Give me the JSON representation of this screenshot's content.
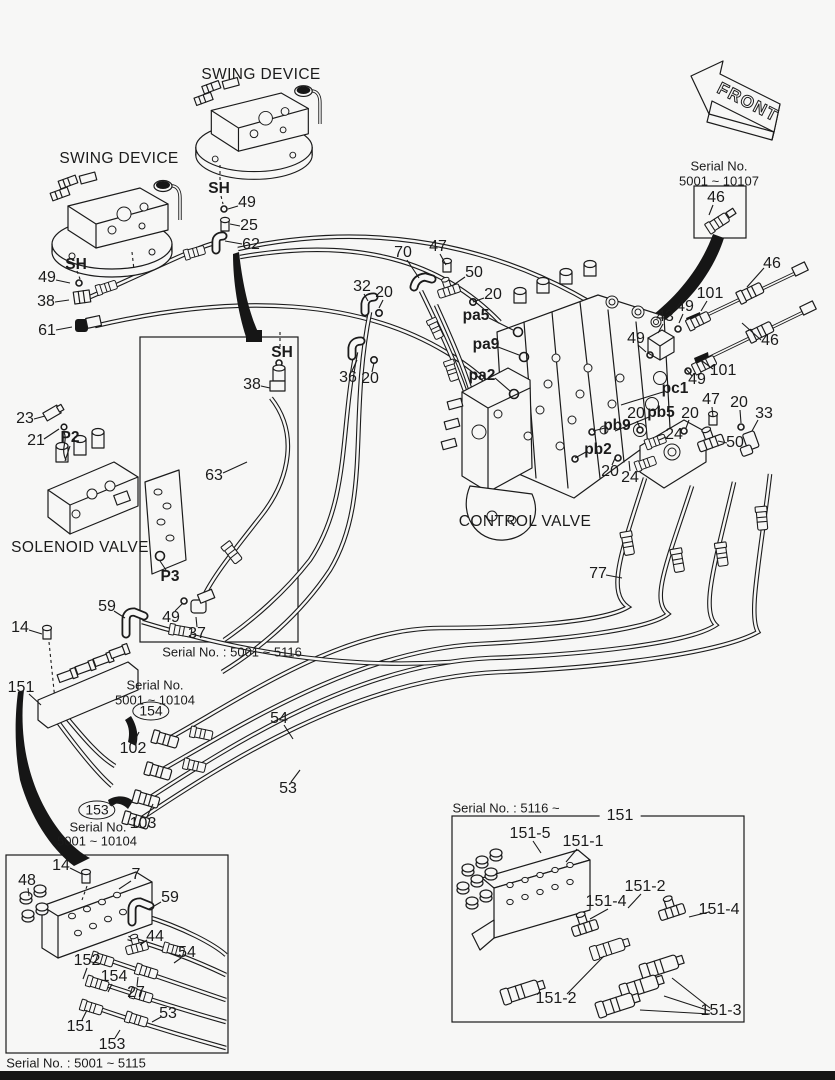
{
  "front_arrow": {
    "label": "FRONT"
  },
  "labels": [
    {
      "t": "SWING DEVICE",
      "x": 261,
      "y": 75,
      "c": "title"
    },
    {
      "t": "SWING DEVICE",
      "x": 119,
      "y": 159,
      "c": "title"
    },
    {
      "t": "SOLENOID VALVE",
      "x": 80,
      "y": 548,
      "c": "title"
    },
    {
      "t": "CONTROL VALVE",
      "x": 525,
      "y": 522,
      "c": "title"
    },
    {
      "t": "Serial No.",
      "x": 719,
      "y": 166,
      "c": "serial"
    },
    {
      "t": "5001 ~ 10107",
      "x": 719,
      "y": 181,
      "c": "serial"
    },
    {
      "t": "46",
      "x": 716,
      "y": 198,
      "c": "num",
      "l": [
        [
          713,
          205,
          709,
          215
        ]
      ]
    },
    {
      "t": "SH",
      "x": 219,
      "y": 189,
      "c": "port"
    },
    {
      "t": "49",
      "x": 247,
      "y": 203,
      "c": "num",
      "l": [
        [
          238,
          206,
          228,
          209
        ]
      ]
    },
    {
      "t": "25",
      "x": 249,
      "y": 226,
      "c": "num",
      "l": [
        [
          240,
          226,
          230,
          224
        ]
      ]
    },
    {
      "t": "62",
      "x": 251,
      "y": 245,
      "c": "num",
      "l": [
        [
          242,
          244,
          225,
          241
        ]
      ]
    },
    {
      "t": "SH",
      "x": 76,
      "y": 265,
      "c": "port"
    },
    {
      "t": "49",
      "x": 47,
      "y": 278,
      "c": "num",
      "l": [
        [
          56,
          280,
          70,
          283
        ]
      ]
    },
    {
      "t": "38",
      "x": 46,
      "y": 302,
      "c": "num",
      "l": [
        [
          55,
          302,
          69,
          300
        ]
      ]
    },
    {
      "t": "61",
      "x": 47,
      "y": 331,
      "c": "num",
      "l": [
        [
          56,
          330,
          72,
          327
        ]
      ]
    },
    {
      "t": "70",
      "x": 403,
      "y": 253,
      "c": "num",
      "l": [
        [
          407,
          260,
          419,
          278
        ]
      ]
    },
    {
      "t": "47",
      "x": 438,
      "y": 247,
      "c": "num",
      "l": [
        [
          440,
          254,
          446,
          265
        ]
      ]
    },
    {
      "t": "50",
      "x": 474,
      "y": 273,
      "c": "num",
      "l": [
        [
          465,
          277,
          452,
          286
        ]
      ]
    },
    {
      "t": "32",
      "x": 362,
      "y": 287,
      "c": "num",
      "l": [
        [
          364,
          294,
          368,
          301
        ]
      ]
    },
    {
      "t": "20",
      "x": 384,
      "y": 293,
      "c": "num",
      "l": [
        [
          383,
          300,
          379,
          308
        ]
      ]
    },
    {
      "t": "20",
      "x": 493,
      "y": 295,
      "c": "num",
      "l": [
        [
          484,
          298,
          473,
          302
        ]
      ]
    },
    {
      "t": "pa5",
      "x": 476,
      "y": 316,
      "c": "port",
      "l": [
        [
          489,
          318,
          513,
          330
        ]
      ]
    },
    {
      "t": "pa9",
      "x": 486,
      "y": 345,
      "c": "port",
      "l": [
        [
          498,
          347,
          519,
          355
        ]
      ]
    },
    {
      "t": "pa2",
      "x": 482,
      "y": 376,
      "c": "port",
      "l": [
        [
          495,
          378,
          510,
          391
        ]
      ]
    },
    {
      "t": "36",
      "x": 348,
      "y": 378,
      "c": "num",
      "l": [
        [
          352,
          371,
          357,
          360
        ]
      ]
    },
    {
      "t": "20",
      "x": 370,
      "y": 379,
      "c": "num",
      "l": [
        [
          372,
          372,
          374,
          363
        ]
      ]
    },
    {
      "t": "46",
      "x": 772,
      "y": 264,
      "c": "num",
      "l": [
        [
          764,
          268,
          747,
          287
        ]
      ]
    },
    {
      "t": "101",
      "x": 710,
      "y": 294,
      "c": "num",
      "l": [
        [
          707,
          301,
          701,
          311
        ]
      ]
    },
    {
      "t": "49",
      "x": 685,
      "y": 307,
      "c": "num",
      "l": [
        [
          683,
          314,
          679,
          323
        ]
      ]
    },
    {
      "t": "43",
      "x": 665,
      "y": 317,
      "c": "num",
      "l": [
        [
          663,
          324,
          658,
          333
        ]
      ]
    },
    {
      "t": "49",
      "x": 636,
      "y": 339,
      "c": "num",
      "l": [
        [
          638,
          345,
          646,
          352
        ]
      ]
    },
    {
      "t": "46",
      "x": 770,
      "y": 341,
      "c": "num",
      "l": [
        [
          761,
          340,
          742,
          323
        ]
      ]
    },
    {
      "t": "101",
      "x": 723,
      "y": 371,
      "c": "num",
      "l": [
        [
          713,
          369,
          702,
          361
        ]
      ]
    },
    {
      "t": "49",
      "x": 697,
      "y": 380,
      "c": "num",
      "l": [
        [
          692,
          376,
          686,
          369
        ]
      ]
    },
    {
      "t": "pc1",
      "x": 675,
      "y": 389,
      "c": "port",
      "l": [
        [
          663,
          392,
          621,
          405
        ]
      ]
    },
    {
      "t": "20",
      "x": 636,
      "y": 414,
      "c": "num",
      "l": [
        [
          637,
          421,
          640,
          428
        ]
      ]
    },
    {
      "t": "pb5",
      "x": 661,
      "y": 413,
      "c": "port",
      "l": [
        [
          649,
          417,
          615,
          431
        ]
      ]
    },
    {
      "t": "20",
      "x": 690,
      "y": 414,
      "c": "num",
      "l": [
        [
          689,
          420,
          686,
          428
        ]
      ]
    },
    {
      "t": "47",
      "x": 711,
      "y": 400,
      "c": "num",
      "l": [
        [
          712,
          407,
          713,
          417
        ]
      ]
    },
    {
      "t": "20",
      "x": 739,
      "y": 403,
      "c": "num",
      "l": [
        [
          740,
          410,
          741,
          423
        ]
      ]
    },
    {
      "t": "33",
      "x": 764,
      "y": 414,
      "c": "num",
      "l": [
        [
          758,
          420,
          752,
          431
        ]
      ]
    },
    {
      "t": "pb9",
      "x": 617,
      "y": 426,
      "c": "port",
      "l": [
        [
          605,
          428,
          593,
          431
        ]
      ]
    },
    {
      "t": "24",
      "x": 674,
      "y": 435,
      "c": "num",
      "l": [
        [
          666,
          437,
          659,
          440
        ]
      ]
    },
    {
      "t": "pb2",
      "x": 598,
      "y": 450,
      "c": "port",
      "l": [
        [
          586,
          452,
          575,
          458
        ]
      ]
    },
    {
      "t": "50",
      "x": 735,
      "y": 443,
      "c": "num",
      "l": [
        [
          727,
          443,
          718,
          441
        ]
      ]
    },
    {
      "t": "20",
      "x": 610,
      "y": 472,
      "c": "num",
      "l": [
        [
          612,
          465,
          616,
          456
        ]
      ]
    },
    {
      "t": "24",
      "x": 630,
      "y": 478,
      "c": "num",
      "l": [
        [
          630,
          471,
          629,
          461
        ]
      ]
    },
    {
      "t": "77",
      "x": 598,
      "y": 574,
      "c": "num",
      "l": [
        [
          606,
          575,
          622,
          578
        ]
      ]
    },
    {
      "t": "23",
      "x": 25,
      "y": 419,
      "c": "num",
      "l": [
        [
          34,
          419,
          45,
          416
        ]
      ]
    },
    {
      "t": "21",
      "x": 36,
      "y": 441,
      "c": "num",
      "l": [
        [
          44,
          439,
          59,
          429
        ]
      ]
    },
    {
      "t": "P2",
      "x": 70,
      "y": 438,
      "c": "port",
      "l": [
        [
          70,
          446,
          65,
          461
        ]
      ]
    },
    {
      "t": "SH",
      "x": 282,
      "y": 353,
      "c": "port"
    },
    {
      "t": "38",
      "x": 252,
      "y": 385,
      "c": "num",
      "l": [
        [
          261,
          386,
          270,
          388
        ]
      ]
    },
    {
      "t": "63",
      "x": 214,
      "y": 476,
      "c": "num",
      "l": [
        [
          223,
          473,
          247,
          462
        ]
      ]
    },
    {
      "t": "P3",
      "x": 170,
      "y": 577,
      "c": "port",
      "l": [
        [
          166,
          570,
          160,
          561
        ]
      ]
    },
    {
      "t": "49",
      "x": 171,
      "y": 618,
      "c": "num",
      "l": [
        [
          175,
          611,
          182,
          604
        ]
      ]
    },
    {
      "t": "37",
      "x": 197,
      "y": 634,
      "c": "num",
      "l": [
        [
          197,
          627,
          196,
          617
        ]
      ]
    },
    {
      "t": "59",
      "x": 107,
      "y": 607,
      "c": "num",
      "l": [
        [
          114,
          611,
          125,
          618
        ]
      ]
    },
    {
      "t": "14",
      "x": 20,
      "y": 628,
      "c": "num",
      "l": [
        [
          29,
          630,
          42,
          634
        ]
      ]
    },
    {
      "t": "151",
      "x": 21,
      "y": 688,
      "c": "num",
      "l": [
        [
          29,
          694,
          41,
          705
        ]
      ]
    },
    {
      "t": "Serial No.",
      "x": 155,
      "y": 685,
      "c": "serial"
    },
    {
      "t": "5001 ~ 10104",
      "x": 155,
      "y": 700,
      "c": "serial"
    },
    {
      "t": "154",
      "x": 151,
      "y": 711,
      "c": "circ"
    },
    {
      "t": "102",
      "x": 133,
      "y": 749,
      "c": "num",
      "l": [
        [
          134,
          742,
          139,
          732
        ]
      ]
    },
    {
      "t": "54",
      "x": 279,
      "y": 719,
      "c": "num",
      "l": [
        [
          284,
          725,
          293,
          739
        ]
      ]
    },
    {
      "t": "53",
      "x": 288,
      "y": 789,
      "c": "num",
      "l": [
        [
          291,
          782,
          300,
          770
        ]
      ]
    },
    {
      "t": "153",
      "x": 97,
      "y": 810,
      "c": "circ",
      "l": [
        [
          111,
          806,
          121,
          800
        ]
      ]
    },
    {
      "t": "Serial No.",
      "x": 98,
      "y": 827,
      "c": "serial"
    },
    {
      "t": "5001 ~ 10104",
      "x": 97,
      "y": 841,
      "c": "serial"
    },
    {
      "t": "103",
      "x": 143,
      "y": 824,
      "c": "num",
      "l": [
        [
          147,
          817,
          153,
          804
        ]
      ]
    },
    {
      "t": "Serial No. : 5001 ~ 5116",
      "x": 232,
      "y": 652,
      "c": "serial"
    },
    {
      "t": "14",
      "x": 61,
      "y": 866,
      "c": "num",
      "l": [
        [
          70,
          868,
          82,
          874
        ]
      ]
    },
    {
      "t": "7",
      "x": 136,
      "y": 875,
      "c": "num",
      "l": [
        [
          131,
          881,
          119,
          889
        ]
      ]
    },
    {
      "t": "48",
      "x": 27,
      "y": 881,
      "c": "num",
      "l": [
        [
          28,
          888,
          29,
          896
        ]
      ]
    },
    {
      "t": "59",
      "x": 170,
      "y": 898,
      "c": "num",
      "l": [
        [
          161,
          902,
          149,
          909
        ]
      ]
    },
    {
      "t": "44",
      "x": 155,
      "y": 937,
      "c": "num",
      "l": [
        [
          147,
          940,
          140,
          945
        ]
      ]
    },
    {
      "t": "54",
      "x": 187,
      "y": 953,
      "c": "num",
      "l": [
        [
          181,
          958,
          174,
          963
        ]
      ]
    },
    {
      "t": "152",
      "x": 87,
      "y": 961,
      "c": "num",
      "l": [
        [
          87,
          968,
          83,
          979
        ]
      ]
    },
    {
      "t": "154",
      "x": 114,
      "y": 977,
      "c": "num",
      "l": [
        [
          112,
          984,
          108,
          992
        ]
      ]
    },
    {
      "t": "27",
      "x": 136,
      "y": 993,
      "c": "num",
      "l": [
        [
          137,
          986,
          138,
          977
        ]
      ]
    },
    {
      "t": "53",
      "x": 168,
      "y": 1014,
      "c": "num",
      "l": [
        [
          161,
          1017,
          152,
          1022
        ]
      ]
    },
    {
      "t": "151",
      "x": 80,
      "y": 1027,
      "c": "num",
      "l": [
        [
          82,
          1020,
          87,
          1010
        ]
      ]
    },
    {
      "t": "153",
      "x": 112,
      "y": 1045,
      "c": "num",
      "l": [
        [
          115,
          1038,
          120,
          1030
        ]
      ]
    },
    {
      "t": "Serial No. : 5001 ~ 5115",
      "x": 76,
      "y": 1063,
      "c": "serial"
    },
    {
      "t": "Serial No. : 5116 ~",
      "x": 506,
      "y": 808,
      "c": "serial"
    },
    {
      "t": "151",
      "x": 620,
      "y": 816,
      "c": "num onbox"
    },
    {
      "t": "151-5",
      "x": 530,
      "y": 834,
      "c": "num",
      "l": [
        [
          533,
          841,
          541,
          853
        ]
      ]
    },
    {
      "t": "151-1",
      "x": 583,
      "y": 842,
      "c": "num",
      "l": [
        [
          577,
          849,
          566,
          862
        ]
      ]
    },
    {
      "t": "151-2",
      "x": 645,
      "y": 887,
      "c": "num",
      "l": [
        [
          641,
          894,
          628,
          908
        ]
      ]
    },
    {
      "t": "151-4",
      "x": 606,
      "y": 902,
      "c": "num",
      "l": [
        [
          608,
          909,
          590,
          919
        ]
      ]
    },
    {
      "t": "151-4",
      "x": 719,
      "y": 910,
      "c": "num",
      "l": [
        [
          709,
          912,
          689,
          917
        ]
      ]
    },
    {
      "t": "151-2",
      "x": 556,
      "y": 999,
      "c": "num",
      "l": [
        [
          567,
          994,
          604,
          956
        ]
      ]
    },
    {
      "t": "151-3",
      "x": 721,
      "y": 1011,
      "c": "num",
      "l": [
        [
          710,
          1008,
          672,
          978
        ],
        [
          710,
          1011,
          664,
          996
        ],
        [
          710,
          1014,
          640,
          1010
        ]
      ]
    }
  ]
}
